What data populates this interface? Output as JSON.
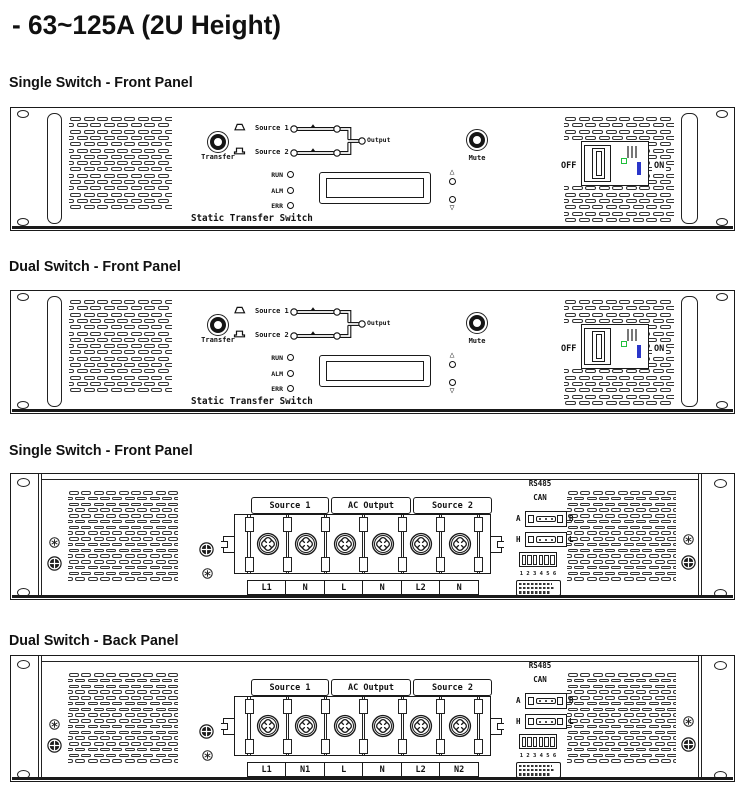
{
  "page": {
    "title": "- 63~125A (2U Height)"
  },
  "sections": [
    {
      "title": "Single Switch - Front Panel"
    },
    {
      "title": "Dual Switch - Front Panel"
    },
    {
      "title": "Single Switch - Front Panel"
    },
    {
      "title": "Dual Switch - Back Panel"
    }
  ],
  "front_panel": {
    "transfer_label": "Transfer",
    "mute_label": "Mute",
    "source1_label": "Source 1",
    "source2_label": "Source 2",
    "output_label": "Output",
    "leds": [
      "RUN",
      "ALM",
      "ERR"
    ],
    "device_label": "Static Transfer Switch",
    "breaker_off": "OFF",
    "breaker_on": "ON",
    "up_glyph": "△",
    "down_glyph": "▽"
  },
  "back_panel": {
    "headers": [
      "Source 1",
      "AC Output",
      "Source 2"
    ],
    "comm": {
      "rs485": "RS485",
      "can": "CAN",
      "a": "A",
      "b": "B",
      "h": "H",
      "l": "L",
      "dip_numbers": "1 2 3 4 5 6"
    }
  },
  "back_panel_single": {
    "terminals": [
      "L1",
      "N",
      "L",
      "N",
      "L2",
      "N"
    ]
  },
  "back_panel_dual": {
    "terminals": [
      "L1",
      "N1",
      "L",
      "N",
      "L2",
      "N2"
    ]
  },
  "colors": {
    "green_indicator": "#1fbf3a",
    "blue_indicator": "#2a35c9",
    "line": "#1a1a1a"
  }
}
